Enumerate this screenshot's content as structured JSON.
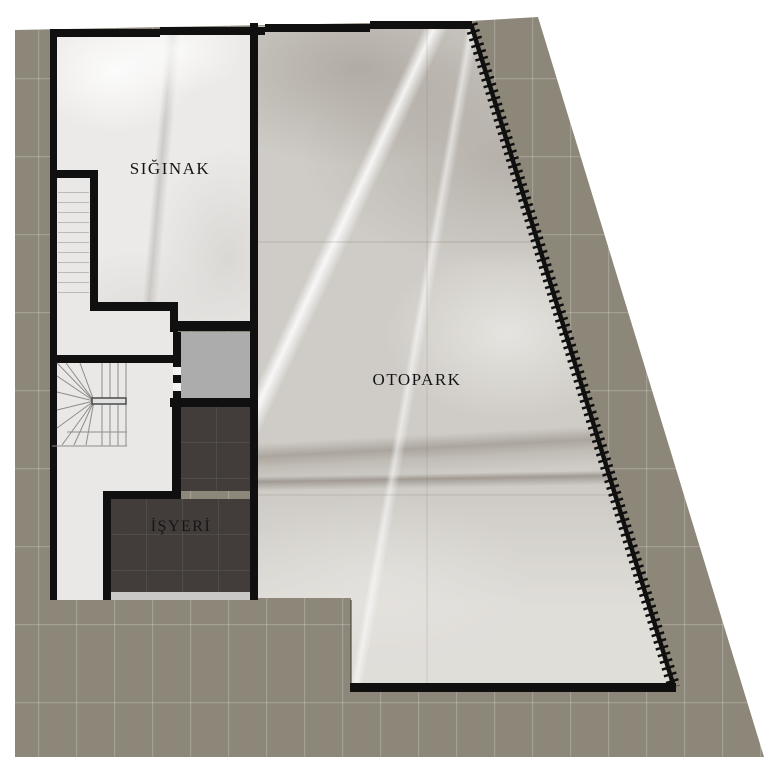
{
  "plan": {
    "type": "architectural-floor-plan",
    "rooms": {
      "siginak": {
        "label": "SIĞINAK"
      },
      "otopark": {
        "label": "OTOPARK"
      },
      "isyeri": {
        "label": "İŞYERİ"
      }
    }
  },
  "colors": {
    "ground_tile": "#8d8779",
    "ground_grout": "#a39d90",
    "wall": "#101010",
    "marble_light": "#eceae8",
    "marble_otopark": "#cfccc7",
    "isyeri_floor": "#423d3a",
    "elevator_shaft": "#acacad",
    "sill": "#c9c8c6",
    "background": "#ffffff"
  }
}
